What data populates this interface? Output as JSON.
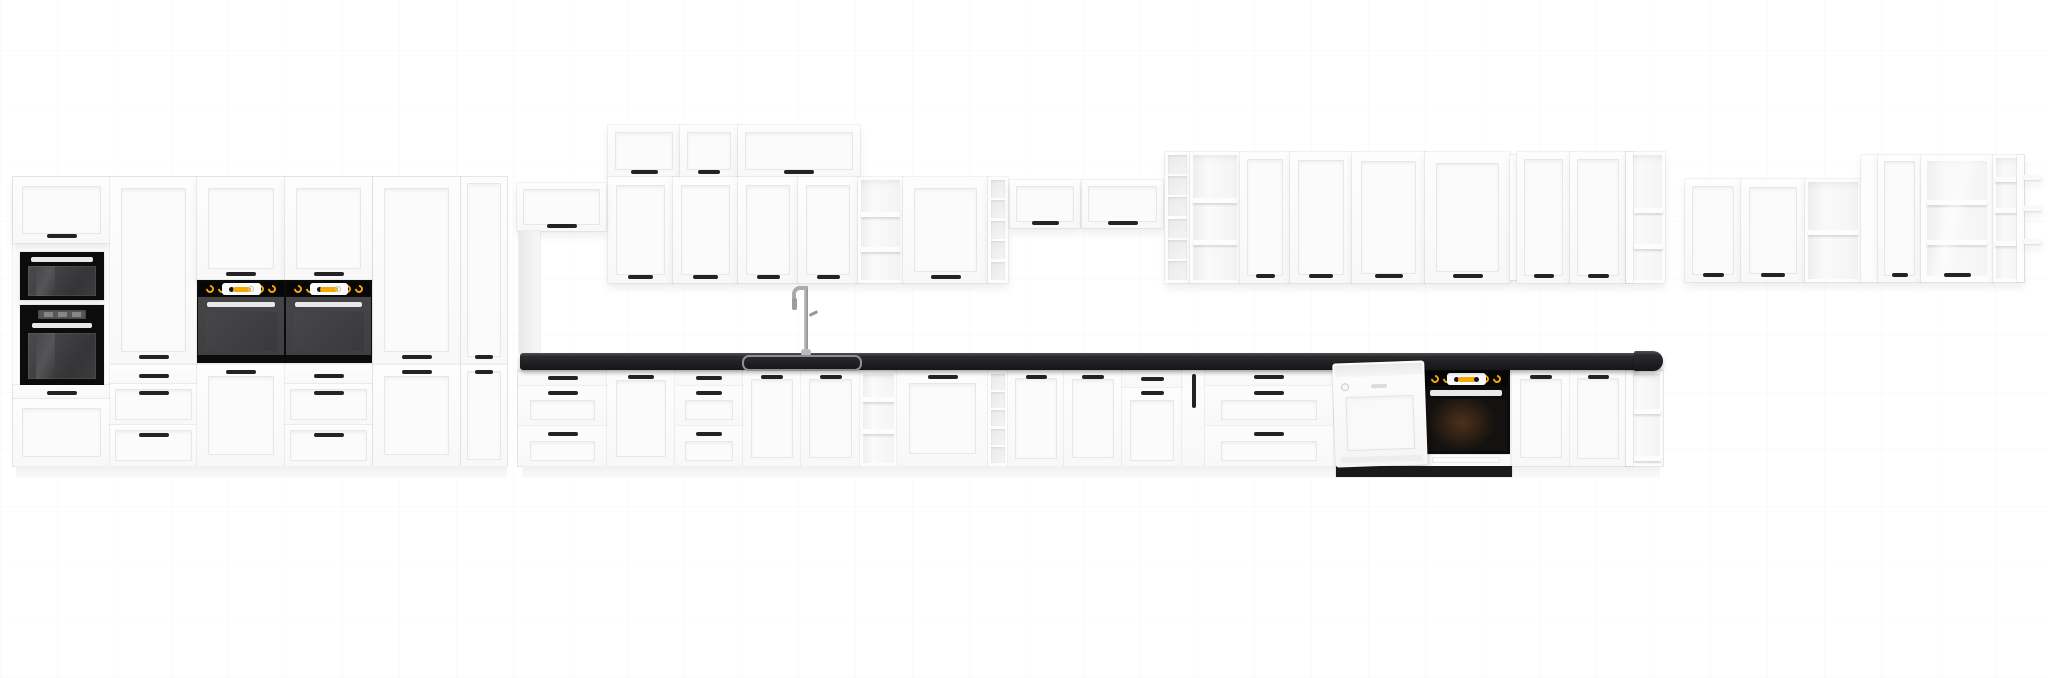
{
  "page": {
    "width": 2048,
    "height": 678,
    "background": "#ffffff"
  },
  "scene": {
    "palette": {
      "cabinet_white": "#fdfdfd",
      "panel_line": "#e7e7e7",
      "handle_black": "#232325",
      "appliance_black": "#0c0c0d",
      "oven_door_gray": "#3f3f41",
      "accent_amber": "#f5a800",
      "countertop_dark": "#202022",
      "steel_gray": "#a9abad",
      "interior_gray": "#ececec",
      "floor_shadow": "rgba(0,0,0,0.13)"
    },
    "units": [
      {
        "n": "wall-flip-cab-1",
        "t": "door",
        "x": 608,
        "y": 125,
        "w": 72,
        "h": 52,
        "hd": 45
      },
      {
        "n": "wall-flip-cab-2",
        "t": "door",
        "x": 680,
        "y": 125,
        "w": 58,
        "h": 52,
        "hd": 45
      },
      {
        "n": "wall-flip-cab-3",
        "t": "door",
        "x": 738,
        "y": 125,
        "w": 122,
        "h": 52,
        "hd": 45,
        "hw": 30
      },
      {
        "n": "wall-door-cab-1",
        "t": "door",
        "x": 608,
        "y": 177,
        "w": 65,
        "h": 106,
        "hd": 98
      },
      {
        "n": "wall-door-cab-2",
        "t": "door",
        "x": 673,
        "y": 177,
        "w": 65,
        "h": 106,
        "hd": 98
      },
      {
        "n": "wall-door-cab-3",
        "t": "door",
        "x": 738,
        "y": 177,
        "w": 60,
        "h": 106,
        "hd": 98
      },
      {
        "n": "wall-door-cab-4",
        "t": "door",
        "x": 798,
        "y": 177,
        "w": 60,
        "h": 106,
        "hd": 98
      },
      {
        "n": "wall-open-shelf-1",
        "t": "open",
        "x": 858,
        "y": 177,
        "w": 45,
        "h": 106,
        "shelves": [
          35,
          70
        ]
      },
      {
        "n": "wall-door-cab-5",
        "t": "door",
        "x": 903,
        "y": 177,
        "w": 85,
        "h": 106,
        "hd": 98
      },
      {
        "n": "wall-rack-column-1",
        "t": "grid",
        "x": 988,
        "y": 177,
        "w": 20,
        "h": 106,
        "cells": 5
      },
      {
        "n": "high-flip-cab-1",
        "t": "door",
        "x": 1010,
        "y": 180,
        "w": 70,
        "h": 48,
        "hd": 41
      },
      {
        "n": "high-flip-cab-2",
        "t": "door",
        "x": 1082,
        "y": 180,
        "w": 81,
        "h": 48,
        "hd": 41
      },
      {
        "n": "wall-rack-column-2",
        "t": "grid",
        "x": 1165,
        "y": 152,
        "w": 25,
        "h": 131,
        "cells": 6
      },
      {
        "n": "wall-open-shelf-2",
        "t": "open",
        "x": 1190,
        "y": 152,
        "w": 50,
        "h": 131,
        "shelves": [
          46,
          88
        ]
      },
      {
        "n": "wall-door-cab-6",
        "t": "door",
        "x": 1240,
        "y": 152,
        "w": 50,
        "h": 131,
        "hd": 122
      },
      {
        "n": "wall-door-cab-7",
        "t": "door",
        "x": 1290,
        "y": 152,
        "w": 62,
        "h": 131,
        "hd": 122
      },
      {
        "n": "wall-door-cab-8",
        "t": "door",
        "x": 1352,
        "y": 152,
        "w": 73,
        "h": 131,
        "hd": 122
      },
      {
        "n": "wall-door-cab-9",
        "t": "door",
        "x": 1425,
        "y": 152,
        "w": 85,
        "h": 131,
        "hd": 122
      },
      {
        "n": "wall-filler-strip",
        "t": "panel",
        "x": 1510,
        "y": 155,
        "w": 7,
        "h": 125
      },
      {
        "n": "wall-door-cab-10",
        "t": "door",
        "x": 1517,
        "y": 152,
        "w": 53,
        "h": 131,
        "hd": 122
      },
      {
        "n": "wall-door-cab-11",
        "t": "door",
        "x": 1570,
        "y": 152,
        "w": 56,
        "h": 131,
        "hd": 122
      },
      {
        "n": "wall-corner-open-shelf",
        "t": "end-open",
        "x": 1626,
        "y": 152,
        "w": 39,
        "h": 131,
        "shelves": [
          56,
          92
        ],
        "side": "left"
      },
      {
        "n": "right-wall-door-cab-1",
        "t": "door",
        "x": 1685,
        "y": 179,
        "w": 56,
        "h": 103,
        "hd": 94
      },
      {
        "n": "right-wall-door-cab-2",
        "t": "door",
        "x": 1741,
        "y": 179,
        "w": 64,
        "h": 103,
        "hd": 94
      },
      {
        "n": "right-wall-open-shelf",
        "t": "open",
        "x": 1805,
        "y": 179,
        "w": 56,
        "h": 103,
        "shelves": [
          51
        ]
      },
      {
        "n": "right-wall-filler",
        "t": "panel",
        "x": 1861,
        "y": 155,
        "w": 17,
        "h": 127
      },
      {
        "n": "right-wall-door-cab-3",
        "t": "door",
        "x": 1878,
        "y": 155,
        "w": 43,
        "h": 127,
        "hd": 118
      },
      {
        "n": "right-wall-glass-cab",
        "t": "glasscab",
        "x": 1921,
        "y": 155,
        "w": 72,
        "h": 127,
        "shelves": [
          45,
          85
        ],
        "hd": 118
      },
      {
        "n": "right-corner-open-shelf",
        "t": "end-open",
        "x": 1993,
        "y": 155,
        "w": 31,
        "h": 127,
        "shelves": [
          22,
          53,
          86
        ],
        "side": "right"
      },
      {
        "n": "corner-shelf-stub-1",
        "t": "stub",
        "x": 2024,
        "y": 175,
        "w": 18,
        "h": 5
      },
      {
        "n": "corner-shelf-stub-2",
        "t": "stub",
        "x": 2024,
        "y": 206,
        "w": 18,
        "h": 5
      },
      {
        "n": "corner-shelf-stub-3",
        "t": "stub",
        "x": 2024,
        "y": 239,
        "w": 18,
        "h": 5
      },
      {
        "n": "hood-cabinet",
        "t": "door",
        "x": 517,
        "y": 183,
        "w": 89,
        "h": 48,
        "hd": 41
      },
      {
        "n": "hood-chimney-panel",
        "t": "panel",
        "x": 519,
        "y": 231,
        "w": 21,
        "h": 122,
        "bg": "linear-gradient(90deg,#e9e9e9,#f7f7f7)"
      },
      {
        "n": "tall-run-carcass",
        "t": "panel",
        "x": 13,
        "y": 177,
        "w": 494,
        "h": 289,
        "bg": "#fcfcfc"
      },
      {
        "n": "tall1-top-door",
        "t": "door",
        "x": 13,
        "y": 177,
        "w": 97,
        "h": 66,
        "hd": 57
      },
      {
        "n": "tall1-microwave",
        "t": "micro",
        "x": 20,
        "y": 252,
        "w": 84,
        "h": 48
      },
      {
        "n": "tall1-oven",
        "t": "ovendisplay",
        "x": 20,
        "y": 305,
        "w": 84,
        "h": 80
      },
      {
        "n": "tall1-small-drawer",
        "t": "door",
        "x": 13,
        "y": 385,
        "w": 97,
        "h": 14,
        "hd": 6,
        "p": 0
      },
      {
        "n": "tall1-bottom-door",
        "t": "door",
        "x": 13,
        "y": 399,
        "w": 97,
        "h": 67
      },
      {
        "n": "tall2-door",
        "t": "door",
        "x": 110,
        "y": 177,
        "w": 87,
        "h": 186,
        "hd": 178
      },
      {
        "n": "tall2-drawer-top",
        "t": "door",
        "x": 110,
        "y": 365,
        "w": 87,
        "h": 19,
        "hd": 9,
        "p": 0
      },
      {
        "n": "tall2-drawer-mid",
        "t": "door",
        "x": 110,
        "y": 384,
        "w": 87,
        "h": 41,
        "hd": 7
      },
      {
        "n": "tall2-drawer-bot",
        "t": "door",
        "x": 110,
        "y": 425,
        "w": 87,
        "h": 41,
        "hd": 8
      },
      {
        "n": "tall3-top-door",
        "t": "door",
        "x": 197,
        "y": 177,
        "w": 88,
        "h": 103,
        "hd": 95
      },
      {
        "n": "tall3-built-in-oven",
        "t": "ovenknobs",
        "x": 197,
        "y": 280,
        "w": 88,
        "h": 83
      },
      {
        "n": "tall3-bottom-door",
        "t": "door",
        "x": 197,
        "y": 365,
        "w": 88,
        "h": 101,
        "hd": 5
      },
      {
        "n": "tall4-top-door",
        "t": "door",
        "x": 285,
        "y": 177,
        "w": 87,
        "h": 103,
        "hd": 95
      },
      {
        "n": "tall4-built-in-oven",
        "t": "ovenknobs",
        "x": 285,
        "y": 280,
        "w": 87,
        "h": 83
      },
      {
        "n": "tall4-drawer-top",
        "t": "door",
        "x": 285,
        "y": 365,
        "w": 87,
        "h": 19,
        "hd": 9,
        "p": 0
      },
      {
        "n": "tall4-drawer-mid",
        "t": "door",
        "x": 285,
        "y": 384,
        "w": 87,
        "h": 41,
        "hd": 7
      },
      {
        "n": "tall4-drawer-bot",
        "t": "door",
        "x": 285,
        "y": 425,
        "w": 87,
        "h": 41,
        "hd": 8
      },
      {
        "n": "tall5-door",
        "t": "door",
        "x": 373,
        "y": 177,
        "w": 87,
        "h": 186,
        "hd": 178
      },
      {
        "n": "tall5-bottom-door",
        "t": "door",
        "x": 373,
        "y": 365,
        "w": 87,
        "h": 101,
        "hd": 5
      },
      {
        "n": "tall6-door",
        "t": "door",
        "x": 461,
        "y": 177,
        "w": 46,
        "h": 186,
        "hd": 178,
        "hw": 18
      },
      {
        "n": "tall6-bottom-door",
        "t": "door",
        "x": 461,
        "y": 365,
        "w": 46,
        "h": 101,
        "hd": 5,
        "hw": 18
      },
      {
        "n": "base-run-carcass",
        "t": "panel",
        "x": 518,
        "y": 370,
        "w": 1145,
        "h": 96,
        "bg": "#fcfcfc"
      },
      {
        "n": "base-drawer-unit-1",
        "t": "drawers",
        "x": 518,
        "y": 371,
        "w": 89,
        "h": 95,
        "rows": [
          {
            "h": 14,
            "hd": 5,
            "p": 0
          },
          {
            "h": 40,
            "hd": 6,
            "p": 1
          },
          {
            "h": 41,
            "hd": 7,
            "p": 1
          }
        ]
      },
      {
        "n": "base-door-cab-1",
        "t": "door",
        "x": 607,
        "y": 371,
        "w": 68,
        "h": 95,
        "hd": 4
      },
      {
        "n": "base-drawer-unit-2",
        "t": "drawers",
        "x": 675,
        "y": 371,
        "w": 68,
        "h": 95,
        "rows": [
          {
            "h": 14,
            "hd": 5,
            "p": 0
          },
          {
            "h": 40,
            "hd": 6,
            "p": 1
          },
          {
            "h": 41,
            "hd": 7,
            "p": 1
          }
        ]
      },
      {
        "n": "sink-base-door-1",
        "t": "door",
        "x": 743,
        "y": 371,
        "w": 58,
        "h": 95,
        "hd": 4
      },
      {
        "n": "sink-base-door-2",
        "t": "door",
        "x": 801,
        "y": 371,
        "w": 59,
        "h": 95,
        "hd": 4
      },
      {
        "n": "base-open-shelf",
        "t": "open",
        "x": 860,
        "y": 371,
        "w": 37,
        "h": 95,
        "shelves": [
          26,
          58
        ]
      },
      {
        "n": "base-door-cab-2",
        "t": "door",
        "x": 897,
        "y": 371,
        "w": 91,
        "h": 95,
        "hd": 4
      },
      {
        "n": "base-rack-column",
        "t": "grid",
        "x": 988,
        "y": 371,
        "w": 20,
        "h": 95,
        "cells": 5
      },
      {
        "n": "base-door-cab-3",
        "t": "door",
        "x": 1008,
        "y": 371,
        "w": 56,
        "h": 95,
        "hd": 4
      },
      {
        "n": "base-door-cab-4",
        "t": "door",
        "x": 1064,
        "y": 371,
        "w": 58,
        "h": 95,
        "hd": 4
      },
      {
        "n": "base-drawer-door-unit",
        "t": "drawers",
        "x": 1122,
        "y": 371,
        "w": 60,
        "h": 95,
        "rows": [
          {
            "h": 16,
            "hd": 6,
            "p": 0
          },
          {
            "h": 79,
            "hd": 4,
            "p": 1
          }
        ]
      },
      {
        "n": "base-cargo-pullout",
        "t": "cargo",
        "x": 1182,
        "y": 371,
        "w": 23,
        "h": 95
      },
      {
        "n": "base-drawer-unit-wide",
        "t": "drawers",
        "x": 1205,
        "y": 371,
        "w": 128,
        "h": 95,
        "hw": 30,
        "rows": [
          {
            "h": 14,
            "hd": 4,
            "p": 0
          },
          {
            "h": 40,
            "hd": 6,
            "p": 1
          },
          {
            "h": 41,
            "hd": 7,
            "p": 1
          }
        ]
      },
      {
        "n": "tall-run-plinth",
        "t": "plinth",
        "x": 16,
        "y": 466,
        "w": 491,
        "h": 12
      },
      {
        "n": "base-run-plinth",
        "t": "plinth",
        "x": 522,
        "y": 466,
        "w": 1138,
        "h": 12
      },
      {
        "n": "appliance-plinth-recess",
        "t": "panel",
        "x": 1336,
        "y": 466,
        "w": 176,
        "h": 11,
        "bg": "#1b1b1d"
      },
      {
        "n": "under-counter-oven",
        "t": "ovenunder",
        "x": 1422,
        "y": 369,
        "w": 88,
        "h": 97
      },
      {
        "n": "base-door-cab-5",
        "t": "door",
        "x": 1512,
        "y": 371,
        "w": 58,
        "h": 95,
        "hd": 4
      },
      {
        "n": "base-door-cab-6",
        "t": "door",
        "x": 1570,
        "y": 371,
        "w": 56,
        "h": 95,
        "hd": 4
      },
      {
        "n": "base-end-open-shelf",
        "t": "end-open",
        "x": 1626,
        "y": 371,
        "w": 37,
        "h": 95,
        "shelves": [
          38,
          85
        ],
        "side": "left"
      },
      {
        "n": "floor-shadow-left",
        "t": "shadow",
        "x": 10,
        "y": 478,
        "w": 505,
        "h": 13
      },
      {
        "n": "floor-shadow-right",
        "t": "shadow",
        "x": 516,
        "y": 478,
        "w": 1150,
        "h": 13
      },
      {
        "n": "countertop",
        "t": "top",
        "x": 520,
        "y": 353,
        "w": 1118,
        "h": 17
      },
      {
        "n": "countertop-end-cap",
        "t": "topcap",
        "x": 1634,
        "y": 351,
        "w": 29,
        "h": 20
      },
      {
        "n": "sink-basin",
        "t": "sink",
        "x": 742,
        "y": 355,
        "w": 116,
        "h": 12
      },
      {
        "n": "sink-faucet",
        "t": "faucet",
        "x": 790,
        "y": 286,
        "w": 30,
        "h": 69
      },
      {
        "n": "dishwasher",
        "t": "dw",
        "x": 1334,
        "y": 362,
        "w": 92,
        "h": 104
      }
    ]
  }
}
